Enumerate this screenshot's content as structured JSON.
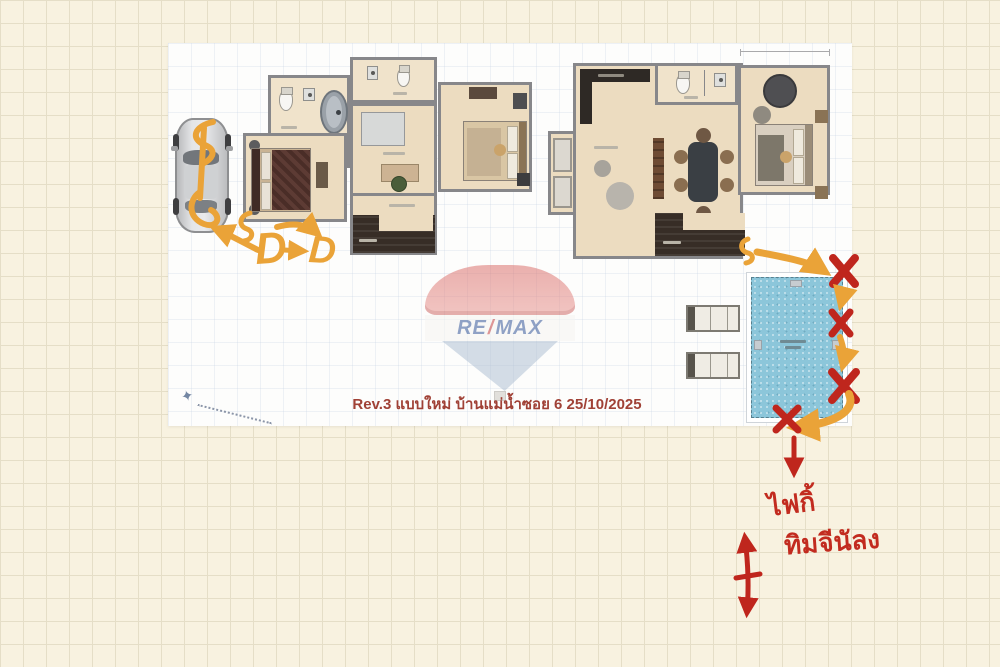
{
  "caption": {
    "text": "Rev.3 แบบใหม่ บ้านแม่น้ำซอย 6 25/10/2025"
  },
  "watermark": {
    "re": "RE",
    "slash": "/",
    "max": "MAX"
  },
  "annotations": {
    "d_first": "D",
    "d_second": "D",
    "s_left": "S",
    "s_right": "S",
    "note_line1": "ไฟกิ้",
    "note_line2": "ทิมจีนัลง",
    "x_marks_count": 4
  },
  "colors": {
    "paper": "#f8f2e0",
    "paper_grid": "#e5dec7",
    "photo_bg": "#fdfdfc",
    "annotation_orange": "#eaa338",
    "annotation_red": "#bf261d",
    "caption_red": "#a04136",
    "pool_water": "#8cc6da"
  }
}
